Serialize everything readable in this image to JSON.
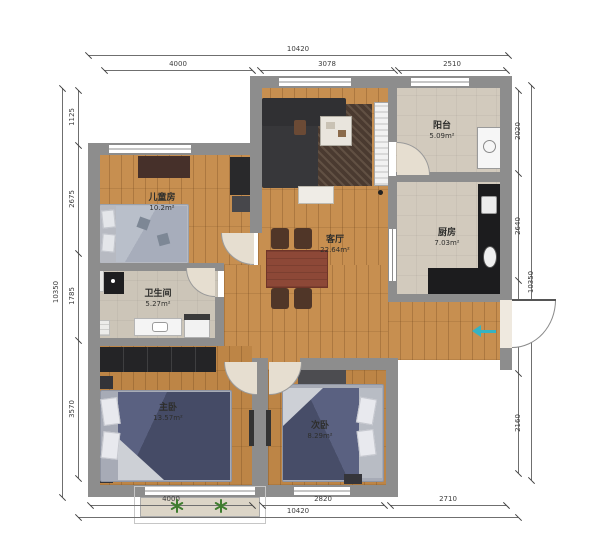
{
  "title": "三居室户型图",
  "rooms": {
    "children": {
      "name": "儿童房",
      "area": "10.2m²"
    },
    "bathroom": {
      "name": "卫生间",
      "area": "5.27m²"
    },
    "living": {
      "name": "客厅",
      "area": "22.64m²"
    },
    "balcony": {
      "name": "阳台",
      "area": "5.09m²"
    },
    "kitchen": {
      "name": "厨房",
      "area": "7.03m²"
    },
    "master": {
      "name": "主卧",
      "area": "13.57m²"
    },
    "second": {
      "name": "次卧",
      "area": "8.29m²"
    }
  },
  "dimensions": {
    "top": {
      "total": "10420",
      "segments": [
        "4000",
        "3078",
        "2510"
      ]
    },
    "bottom": {
      "total": "10420",
      "segments": [
        "4000",
        "2820",
        "2710"
      ]
    },
    "left": {
      "total": "10350",
      "segments": [
        "1125",
        "2675",
        "1785",
        "3570"
      ]
    },
    "right": {
      "total": "10350",
      "segments": [
        "2020",
        "2640",
        "1870",
        "2160"
      ]
    }
  },
  "colors": {
    "wall": "#8d8d8d",
    "wood_floor": "#c78f50",
    "tile_floor": "#d2cabd",
    "bed_duvet": "#474d68",
    "kitchen_counter": "#1c1c1e",
    "dining_table": "#8d4837",
    "entry_arrow": "#35b3c3",
    "plant": "#3f7d2f"
  },
  "icons": {
    "plant": "asterisk-plant",
    "entry_arrow": "left-arrow"
  },
  "furniture": [
    "sofa",
    "rug",
    "coffee-table",
    "radiator",
    "dining-table",
    "dining-chair",
    "child-bed",
    "wardrobe",
    "desk",
    "shower-unit",
    "vanity",
    "washer",
    "master-bed",
    "nightstand",
    "second-bed",
    "bench",
    "kitchen-counter",
    "sink",
    "stove",
    "washing-machine"
  ]
}
